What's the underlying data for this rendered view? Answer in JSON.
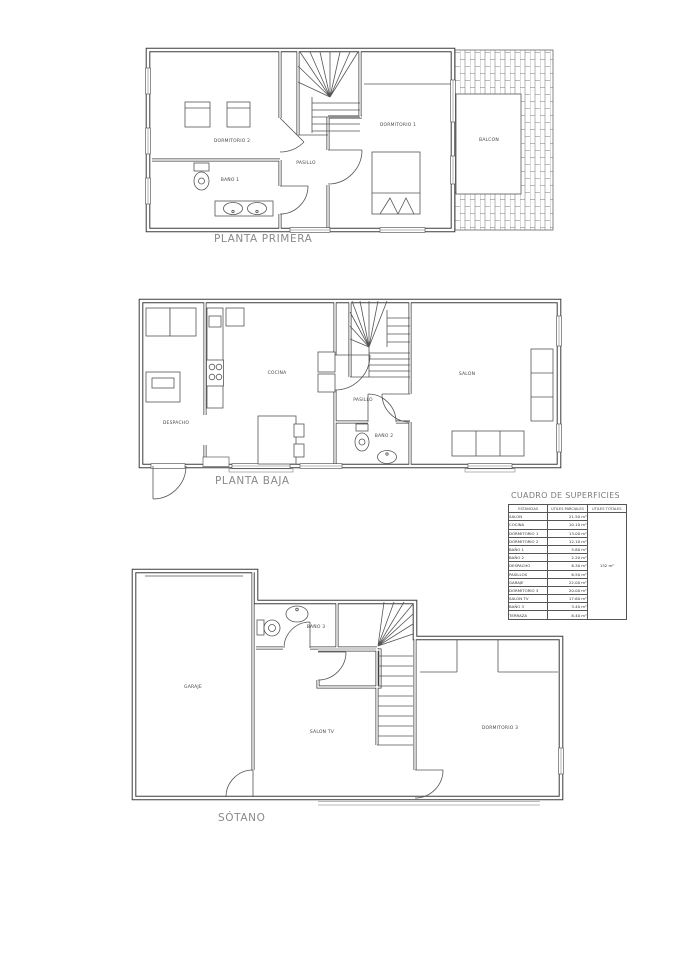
{
  "titles": {
    "planta_primera": "PLANTA PRIMERA",
    "planta_baja": "PLANTA BAJA",
    "sotano": "SÓTANO"
  },
  "plans": {
    "primera": {
      "labels": {
        "dormitorio2": "DORMITORIO 2",
        "bano1": "BAÑO 1",
        "pasillo": "PASILLO",
        "dormitorio1": "DORMITORIO 1",
        "balcon": "BALCON"
      }
    },
    "baja": {
      "labels": {
        "cocina": "COCINA",
        "despacho": "DESPACHO",
        "pasillo": "PASILLO",
        "bano2": "BAÑO 2",
        "salon": "SALON"
      }
    },
    "sotano": {
      "labels": {
        "garaje": "GARAJE",
        "bano3": "BAÑO 3",
        "salontv": "SALON TV",
        "dormitorio3": "DORMITORIO 3"
      }
    }
  },
  "table": {
    "title": "CUADRO DE SUPERFICIES",
    "headers": [
      "ESTANCIAS",
      "UTILES PARCIALES",
      "UTILES TOTALES"
    ],
    "rows": [
      {
        "name": "SALON",
        "value": "21.50 m²"
      },
      {
        "name": "COCINA",
        "value": "10.10 m²"
      },
      {
        "name": "DORMITORIO 1",
        "value": "13.00 m²"
      },
      {
        "name": "DORMITORIO 2",
        "value": "12.10 m²"
      },
      {
        "name": "BAÑO 1",
        "value": "5.80 m²"
      },
      {
        "name": "BAÑO 2",
        "value": "2.20 m²"
      },
      {
        "name": "DESPACHO",
        "value": "6.30 m²"
      },
      {
        "name": "PASILLOS",
        "value": "6.50 m²"
      },
      {
        "name": "GARAJE",
        "value": "22.00 m²"
      },
      {
        "name": "DORMITORIO 3",
        "value": "20.00 m²"
      },
      {
        "name": "SALON TV",
        "value": "17.60 m²"
      },
      {
        "name": "BAÑO 3",
        "value": "3.40 m²"
      },
      {
        "name": "TERRAZA",
        "value": "8.40 m²"
      }
    ],
    "total": "132 m²"
  }
}
